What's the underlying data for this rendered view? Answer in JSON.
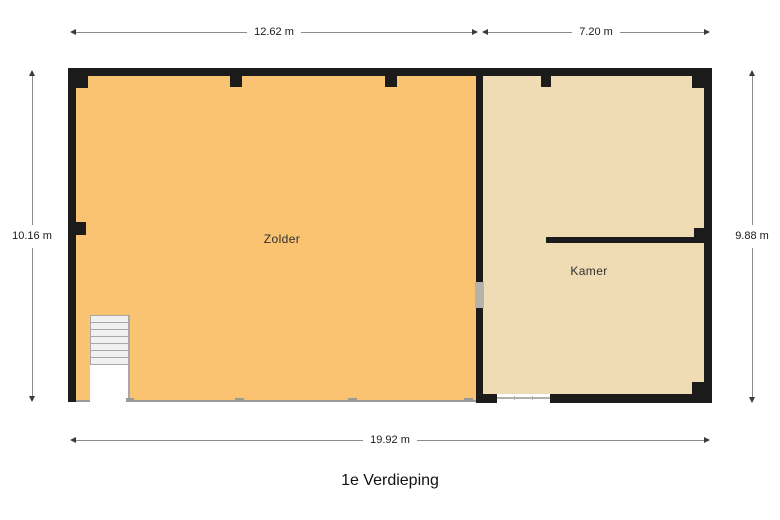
{
  "title": "1e Verdieping",
  "floor_plan": {
    "rooms": [
      {
        "name": "Zolder"
      },
      {
        "name": "Kamer"
      }
    ],
    "dimensions": {
      "top_zolder": "12.62 m",
      "top_kamer": "7.20 m",
      "left": "10.16 m",
      "right": "9.88 m",
      "bottom": "19.92 m"
    }
  },
  "colors": {
    "zolder_floor": "#f9c372",
    "kamer_floor": "#f0dcb4",
    "wall": "#1b1b1b",
    "dim_line": "#8c8c8c",
    "dim_text": "#1a1a1a",
    "stair_fill": "#f0f0f0",
    "stair_line": "#a8a8a8",
    "floor_edge": "#9a9a9a",
    "door_opening": "#b5b2ab",
    "window_line": "#b0b0b0"
  }
}
